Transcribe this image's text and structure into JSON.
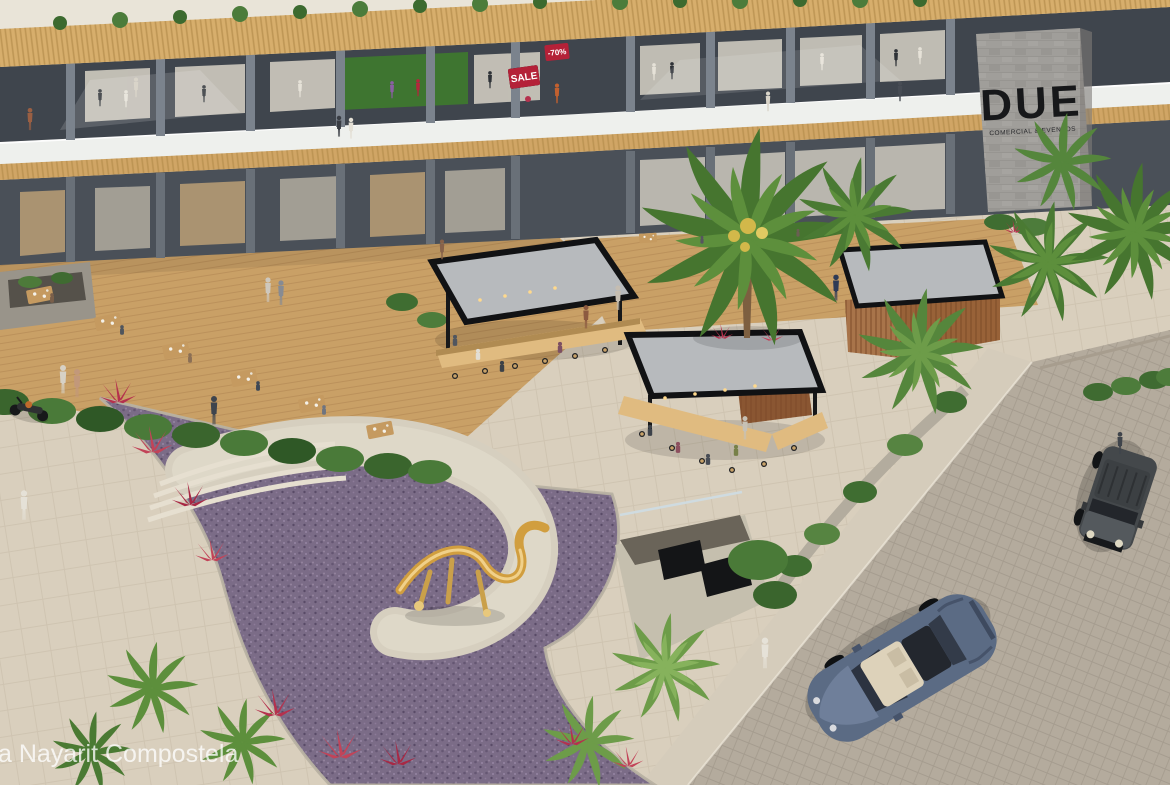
{
  "scene": {
    "type": "aerial architectural rendering of a two-story open-air shopping plaza with food kiosks, palms, sculpture garden and street parking",
    "watermark": "a Nayarit Compostela",
    "tower_sign": {
      "brand": "DUE",
      "subtitle": "COMERCIAL & EVENTOS"
    },
    "store_signs": {
      "sale": "SALE",
      "discount": "-70%"
    },
    "palette": {
      "pavement": "#d9cfbd",
      "street": "#b4ab9d",
      "sidewalk": "#d5ccbb",
      "fascia_wood": "#d7ae6c",
      "building_dark": "#3f454d",
      "white_band": "#eef0ed",
      "canopy_wood": "#d0a565",
      "ground_dark": "#4a5058",
      "kiosk_roof": "#b7babd",
      "kiosk_frame": "#111214",
      "counter_wood": "#e0bb80",
      "sign_red": "#b42138",
      "purple_flowers": "#7b6c87",
      "palm_green": "#46752f",
      "hedge_green": "#3f6b31",
      "sculpture_gold": "#d19e3f",
      "concrete": "#d6cfbf",
      "suv_gray": "#44484b",
      "sedan_blue": "#5b6b84",
      "tower_stone": "#a09e9a"
    }
  }
}
